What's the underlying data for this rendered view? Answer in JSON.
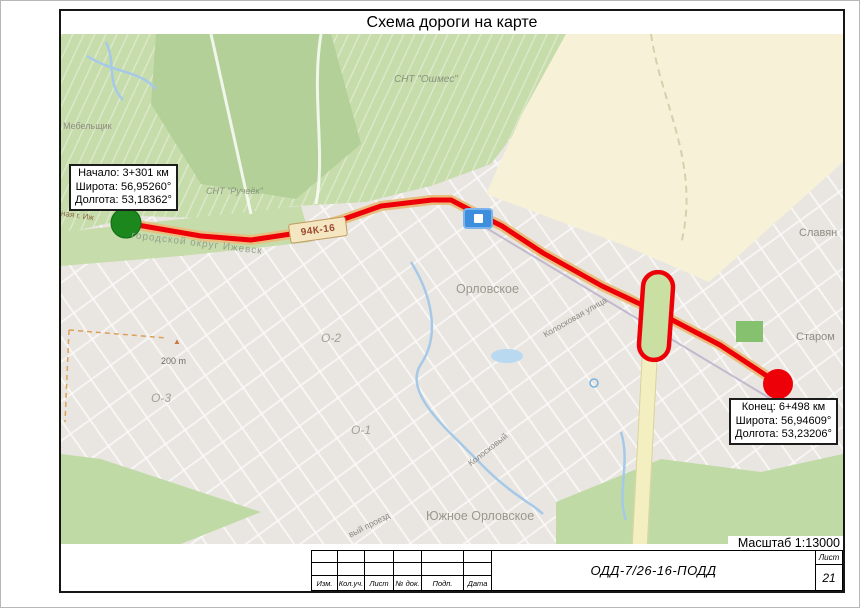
{
  "title": "Схема дороги на карте",
  "scale_note": "Масштаб 1:13000",
  "annotations": {
    "start": {
      "line1": "Начало: 3+301 км",
      "line2": "Широта: 56,95260°",
      "line3": "Долгота: 53,18362°"
    },
    "end": {
      "line1": "Конец: 6+498 км",
      "line2": "Широта: 56,94609°",
      "line3": "Долгота: 53,23206°"
    }
  },
  "map": {
    "badge": "94К-16",
    "scale_bar": "200 m",
    "peak_icon": "▲",
    "labels": [
      {
        "text": "СНТ \"Ошмес\""
      },
      {
        "text": "СНТ \"Ручеёк\""
      },
      {
        "text": "Мебельщик"
      },
      {
        "text": "Орловское"
      },
      {
        "text": "Славян"
      },
      {
        "text": "Старом"
      },
      {
        "text": "О-2"
      },
      {
        "text": "О-3"
      },
      {
        "text": "О-1"
      },
      {
        "text": "Южное Орловское"
      },
      {
        "text": "городской округ Ижевск"
      },
      {
        "text": "ная г. Иж"
      },
      {
        "text": "Колосковая улица"
      },
      {
        "text": "Колосковый"
      },
      {
        "text": "вый проезд"
      }
    ]
  },
  "titleblock": {
    "columns": [
      "Изм.",
      "Кол.уч.",
      "Лист",
      "№ док.",
      "Подп.",
      "Дата"
    ],
    "doc_number": "ОДД-7/26-16-ПОДД",
    "sheet_label": "Лист",
    "sheet_number": "21"
  },
  "colors": {
    "route": "#ee0008",
    "start_marker": "#1c871c",
    "end_marker": "#ee0008",
    "highlight_oval": "#ee0008",
    "road_fill": "#e8bd7e",
    "sign_blue": "#3e8ede"
  }
}
